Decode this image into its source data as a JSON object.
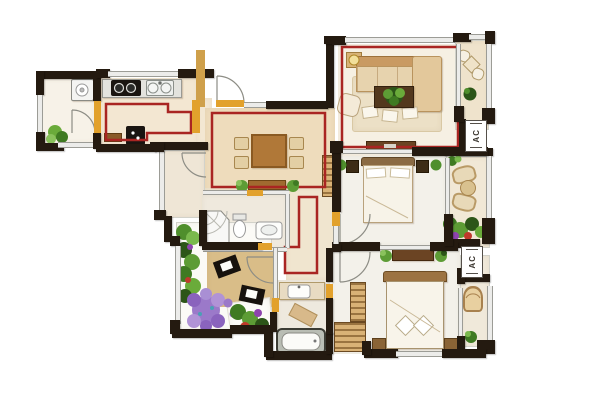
{
  "labels": {
    "ac_unit_1": "AC",
    "ac_unit_2": "AC"
  },
  "palette": {
    "wall": "#241a10",
    "outline_red": "#a92522",
    "door_marker_yellow": "#e2a12c",
    "wood_floor": "#eedcbc",
    "study_tile": "#d9bd88",
    "plant_green": "#5d9c35",
    "rug_purple": "#9b79c9",
    "sofa_tan": "#e7d3ae",
    "dark_furniture": "#5a3c1e"
  }
}
